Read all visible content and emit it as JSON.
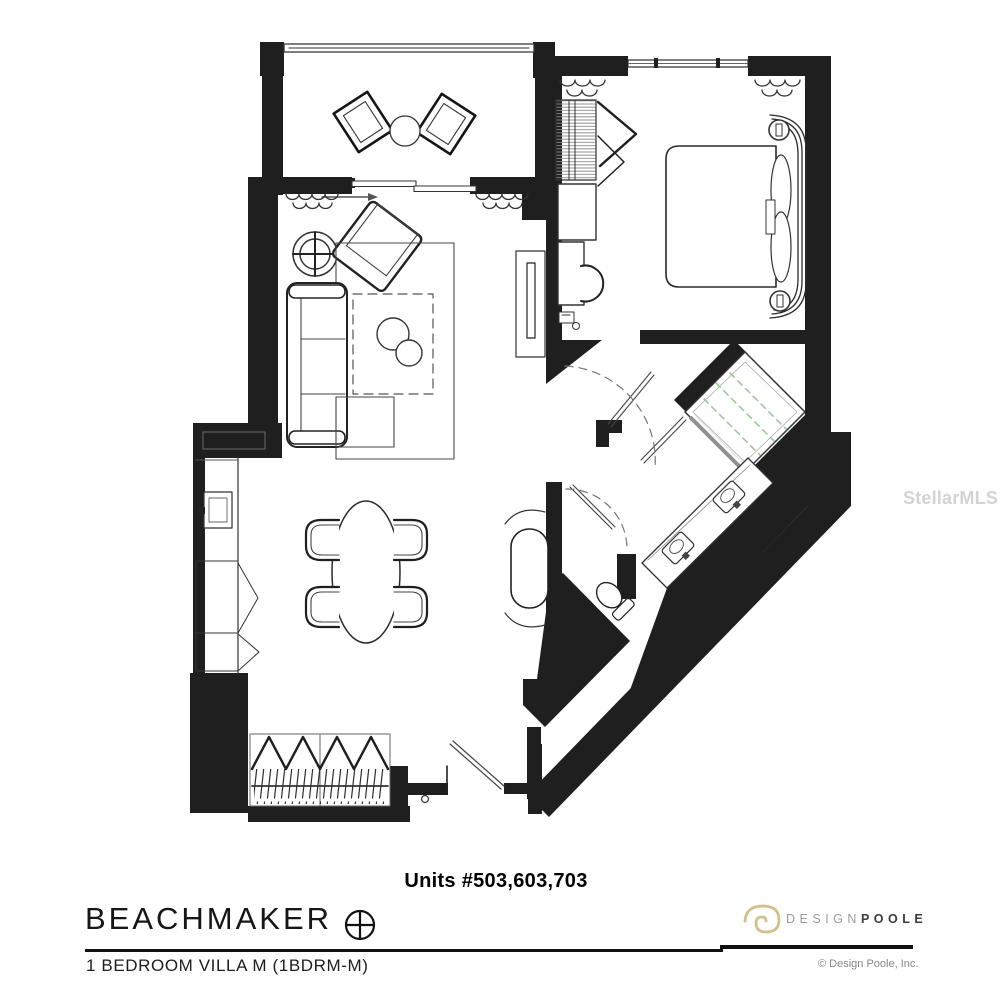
{
  "plan": {
    "units_label": "Units #503,603,703",
    "project_name": "BEACHMAKER",
    "unit_type_label": "1 BEDROOM VILLA M (1BDRM-M)"
  },
  "branding": {
    "brand_design": "DESIGN",
    "brand_poole": "POOLE",
    "copyright": "© Design Poole, Inc.",
    "logo_gold": "#d3c18c"
  },
  "watermark": {
    "text": "StellarMLS"
  },
  "colors": {
    "walls": "#1f1f1f",
    "linework": "#333333",
    "light_line": "#666666",
    "shower_glass": "#9cc89c",
    "divider": "#111111",
    "muted_text": "#868686",
    "watermark_gray": "#c9c9c9"
  },
  "icons": {
    "north_compass": "circle-with-crosshair",
    "ceiling_fan": "double-circle-crosshair",
    "designpoole_spiral": "gold-spiral"
  }
}
